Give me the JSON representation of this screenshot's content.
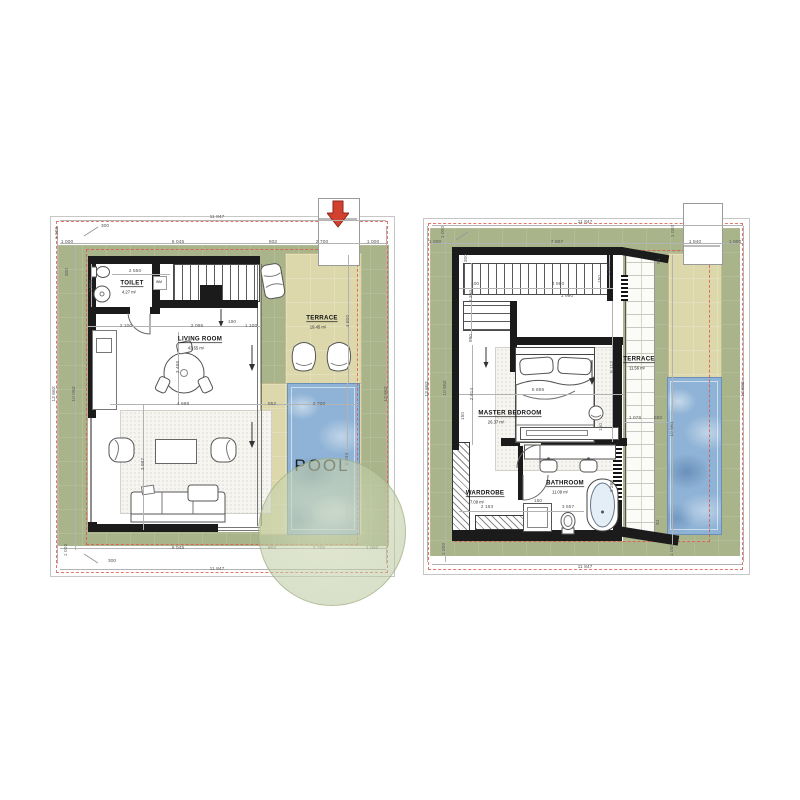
{
  "colors": {
    "plot_green": "#a9b48a",
    "terrace_tan": "#ddd8ab",
    "pool_blue": "#8fb3d6",
    "wall_black": "#1b1b1b",
    "boundary_red": "#df5448",
    "arrow_red": "#d2402e"
  },
  "plans": {
    "ground": {
      "rooms": {
        "toilet": {
          "name": "TOILET",
          "area": "4.27 m²"
        },
        "living": {
          "name": "LIVING ROOM",
          "area": "43.55 m²"
        },
        "terrace": {
          "name": "TERRACE",
          "area": "19.45 m²"
        },
        "pool_label": "POOL",
        "wm_label": "WM"
      },
      "dims": [
        {
          "t": "11 847",
          "x": 167,
          "y": 5
        },
        {
          "t": "300",
          "x": 55,
          "y": 14
        },
        {
          "t": "1 000",
          "x": 17,
          "y": 30
        },
        {
          "t": "6 045",
          "x": 128,
          "y": 30
        },
        {
          "t": "802",
          "x": 223,
          "y": 30
        },
        {
          "t": "2 700",
          "x": 272,
          "y": 30
        },
        {
          "t": "1 000",
          "x": 323,
          "y": 30
        },
        {
          "t": "1 000",
          "x": 7,
          "y": 21,
          "r": -90
        },
        {
          "t": "300",
          "x": 17,
          "y": 60,
          "r": -90
        },
        {
          "t": "12 662",
          "x": 4,
          "y": 182,
          "r": -90
        },
        {
          "t": "10 062",
          "x": 24,
          "y": 182,
          "r": -90
        },
        {
          "t": "2 550",
          "x": 85,
          "y": 59
        },
        {
          "t": "1 850",
          "x": 41,
          "y": 74,
          "r": -90
        },
        {
          "t": "2 100",
          "x": 76,
          "y": 114
        },
        {
          "t": "2 095",
          "x": 147,
          "y": 114
        },
        {
          "t": "190",
          "x": 182,
          "y": 110
        },
        {
          "t": "1 100",
          "x": 201,
          "y": 114
        },
        {
          "t": "3 465",
          "x": 128,
          "y": 155,
          "r": -90
        },
        {
          "t": "4 988",
          "x": 133,
          "y": 192
        },
        {
          "t": "852",
          "x": 222,
          "y": 192
        },
        {
          "t": "2 700",
          "x": 269,
          "y": 192
        },
        {
          "t": "3 997",
          "x": 93,
          "y": 252,
          "r": -90
        },
        {
          "t": "4 800",
          "x": 298,
          "y": 109,
          "r": -90
        },
        {
          "t": "5 244",
          "x": 297,
          "y": 247,
          "r": -90
        },
        {
          "t": "12 662",
          "x": 336,
          "y": 182,
          "r": -90
        },
        {
          "t": "6 045",
          "x": 128,
          "y": 336
        },
        {
          "t": "802",
          "x": 222,
          "y": 336
        },
        {
          "t": "2 700",
          "x": 269,
          "y": 336
        },
        {
          "t": "1 000",
          "x": 322,
          "y": 336
        },
        {
          "t": "1 000",
          "x": 16,
          "y": 338,
          "r": -90
        },
        {
          "t": "300",
          "x": 62,
          "y": 349
        },
        {
          "t": "11 847",
          "x": 167,
          "y": 357
        }
      ]
    },
    "upper": {
      "rooms": {
        "master": {
          "name": "MASTER BEDROOM",
          "area": "26.37 m²"
        },
        "wardrobe": {
          "name": "WARDROBE",
          "area": "7.09 m²"
        },
        "bathroom": {
          "name": "BATHROOM",
          "area": "11.09 m²"
        },
        "terrace": {
          "name": "TERRACE",
          "area": "11.56 m²"
        }
      },
      "dims": [
        {
          "t": "11 847",
          "x": 165,
          "y": 10
        },
        {
          "t": "1 000",
          "x": 15,
          "y": 30
        },
        {
          "t": "7 907",
          "x": 137,
          "y": 30
        },
        {
          "t": "1 000",
          "x": 253,
          "y": 19,
          "r": -90
        },
        {
          "t": "1 940",
          "x": 275,
          "y": 30
        },
        {
          "t": "1 000",
          "x": 315,
          "y": 30
        },
        {
          "t": "1 000",
          "x": 23,
          "y": 20,
          "r": -90
        },
        {
          "t": "300",
          "x": 46,
          "y": 46,
          "r": -90
        },
        {
          "t": "100",
          "x": 55,
          "y": 72
        },
        {
          "t": "2 350",
          "x": 51,
          "y": 84,
          "r": -90
        },
        {
          "t": "4 980",
          "x": 138,
          "y": 72
        },
        {
          "t": "150",
          "x": 180,
          "y": 67,
          "r": -90
        },
        {
          "t": "1 400",
          "x": 189,
          "y": 57,
          "r": -90
        },
        {
          "t": "990",
          "x": 51,
          "y": 126,
          "r": -90
        },
        {
          "t": "1 990",
          "x": 147,
          "y": 84
        },
        {
          "t": "5 112",
          "x": 192,
          "y": 155,
          "r": -90
        },
        {
          "t": "5 895",
          "x": 118,
          "y": 178
        },
        {
          "t": "2 914",
          "x": 52,
          "y": 182,
          "r": -90
        },
        {
          "t": "150",
          "x": 43,
          "y": 204,
          "r": -90
        },
        {
          "t": "150",
          "x": 181,
          "y": 215,
          "r": -90
        },
        {
          "t": "1 076",
          "x": 215,
          "y": 206
        },
        {
          "t": "582",
          "x": 238,
          "y": 206
        },
        {
          "t": "10 561",
          "x": 252,
          "y": 217,
          "r": -90
        },
        {
          "t": "51",
          "x": 239,
          "y": 49,
          "r": -90
        },
        {
          "t": "51",
          "x": 238,
          "y": 310,
          "r": -90
        },
        {
          "t": "2 183",
          "x": 67,
          "y": 295
        },
        {
          "t": "150",
          "x": 118,
          "y": 289
        },
        {
          "t": "3 557",
          "x": 148,
          "y": 295
        },
        {
          "t": "3 280",
          "x": 192,
          "y": 274,
          "r": -90
        },
        {
          "t": "12 662",
          "x": 7,
          "y": 177,
          "r": -90
        },
        {
          "t": "10 662",
          "x": 25,
          "y": 176,
          "r": -90
        },
        {
          "t": "12 662",
          "x": 323,
          "y": 177,
          "r": -90
        },
        {
          "t": "1 000",
          "x": 24,
          "y": 337,
          "r": -90
        },
        {
          "t": "1 000",
          "x": 252,
          "y": 338,
          "r": -90
        },
        {
          "t": "11 847",
          "x": 165,
          "y": 355
        }
      ]
    }
  }
}
